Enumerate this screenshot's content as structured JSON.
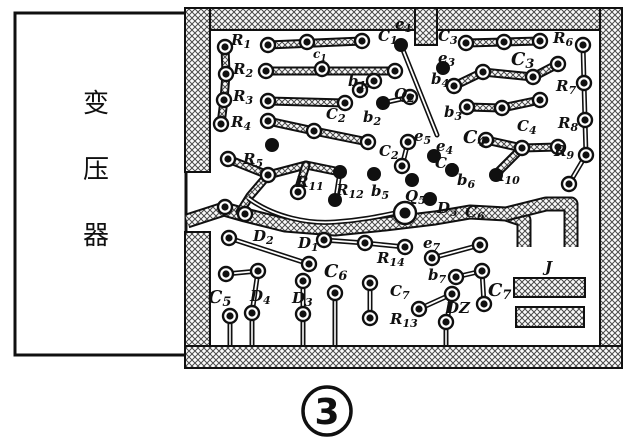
{
  "figure": {
    "caption_number": "3"
  },
  "transformer": {
    "label": "变压器",
    "chars": [
      "变",
      "压",
      "器"
    ]
  },
  "board": {
    "border_color": "#101010",
    "hatch_color": "#4a4a4a",
    "labels": [
      {
        "t": "R",
        "s": "1",
        "x": 231,
        "y": 45
      },
      {
        "t": "R",
        "s": "2",
        "x": 233,
        "y": 74
      },
      {
        "t": "R",
        "s": "3",
        "x": 233,
        "y": 101
      },
      {
        "t": "R",
        "s": "4",
        "x": 231,
        "y": 127
      },
      {
        "t": "R",
        "s": "5",
        "x": 243,
        "y": 164
      },
      {
        "t": "C",
        "s": "1",
        "x": 378,
        "y": 41
      },
      {
        "t": "c",
        "s": "1",
        "x": 313,
        "y": 58,
        "small": true
      },
      {
        "t": "e",
        "s": "1",
        "x": 395,
        "y": 29
      },
      {
        "t": "b",
        "s": "1",
        "x": 348,
        "y": 86
      },
      {
        "t": "C",
        "s": "2",
        "x": 326,
        "y": 119
      },
      {
        "t": "b",
        "s": "2",
        "x": 363,
        "y": 122
      },
      {
        "t": "C",
        "s": "2",
        "x": 379,
        "y": 156
      },
      {
        "t": "Q",
        "s": "2",
        "x": 394,
        "y": 99
      },
      {
        "t": "C",
        "s": "3",
        "x": 438,
        "y": 41
      },
      {
        "t": "e",
        "s": "3",
        "x": 438,
        "y": 63
      },
      {
        "t": "b",
        "s": "4",
        "x": 431,
        "y": 84
      },
      {
        "t": "C",
        "s": "3",
        "x": 511,
        "y": 65,
        "bold": true
      },
      {
        "t": "R",
        "s": "6",
        "x": 553,
        "y": 43
      },
      {
        "t": "R",
        "s": "7",
        "x": 556,
        "y": 91
      },
      {
        "t": "b",
        "s": "3",
        "x": 444,
        "y": 117
      },
      {
        "t": "C",
        "s": "4",
        "x": 463,
        "y": 143,
        "bold": true
      },
      {
        "t": "C",
        "s": "4",
        "x": 517,
        "y": 131
      },
      {
        "t": "R",
        "s": "8",
        "x": 558,
        "y": 128
      },
      {
        "t": "R",
        "s": "9",
        "x": 554,
        "y": 156
      },
      {
        "t": "e",
        "s": "5",
        "x": 414,
        "y": 141
      },
      {
        "t": "e",
        "s": "4",
        "x": 436,
        "y": 151
      },
      {
        "t": "C",
        "s": "6",
        "x": 435,
        "y": 168
      },
      {
        "t": "b",
        "s": "6",
        "x": 457,
        "y": 185
      },
      {
        "t": "R",
        "s": "10",
        "x": 492,
        "y": 181
      },
      {
        "t": "b",
        "s": "5",
        "x": 371,
        "y": 196
      },
      {
        "t": "Q",
        "s": "5",
        "x": 405,
        "y": 201
      },
      {
        "t": "D",
        "s": "5",
        "x": 437,
        "y": 213
      },
      {
        "t": "C",
        "s": "6",
        "x": 465,
        "y": 217
      },
      {
        "t": "R",
        "s": "11",
        "x": 296,
        "y": 187
      },
      {
        "t": "R",
        "s": "12",
        "x": 336,
        "y": 195
      },
      {
        "t": "D",
        "s": "2",
        "x": 253,
        "y": 241
      },
      {
        "t": "D",
        "s": "1",
        "x": 298,
        "y": 248
      },
      {
        "t": "R",
        "s": "14",
        "x": 377,
        "y": 263
      },
      {
        "t": "C",
        "s": "6",
        "x": 324,
        "y": 277,
        "bold": true
      },
      {
        "t": "e",
        "s": "7",
        "x": 423,
        "y": 248
      },
      {
        "t": "b",
        "s": "7",
        "x": 428,
        "y": 280
      },
      {
        "t": "C",
        "s": "7",
        "x": 390,
        "y": 296
      },
      {
        "t": "C",
        "s": "7",
        "x": 488,
        "y": 296,
        "bold": true
      },
      {
        "t": "DZ",
        "s": "",
        "x": 446,
        "y": 313
      },
      {
        "t": "R",
        "s": "13",
        "x": 390,
        "y": 324
      },
      {
        "t": "J",
        "s": "",
        "x": 545,
        "y": 272
      },
      {
        "t": "C",
        "s": "5",
        "x": 208,
        "y": 303,
        "bold": true
      },
      {
        "t": "D",
        "s": "4",
        "x": 250,
        "y": 301
      },
      {
        "t": "D",
        "s": "3",
        "x": 292,
        "y": 303
      }
    ],
    "pads_ring": [
      [
        225,
        47
      ],
      [
        226,
        74
      ],
      [
        224,
        100
      ],
      [
        221,
        124
      ],
      [
        228,
        159
      ],
      [
        268,
        45
      ],
      [
        307,
        42
      ],
      [
        362,
        41
      ],
      [
        266,
        71
      ],
      [
        322,
        69
      ],
      [
        395,
        71
      ],
      [
        268,
        101
      ],
      [
        345,
        103
      ],
      [
        360,
        90
      ],
      [
        374,
        81
      ],
      [
        268,
        121
      ],
      [
        314,
        131
      ],
      [
        368,
        142
      ],
      [
        410,
        97
      ],
      [
        466,
        43
      ],
      [
        504,
        42
      ],
      [
        540,
        41
      ],
      [
        583,
        45
      ],
      [
        454,
        86
      ],
      [
        483,
        72
      ],
      [
        533,
        77
      ],
      [
        558,
        64
      ],
      [
        584,
        83
      ],
      [
        467,
        107
      ],
      [
        502,
        108
      ],
      [
        540,
        100
      ],
      [
        585,
        120
      ],
      [
        486,
        140
      ],
      [
        522,
        148
      ],
      [
        558,
        147
      ],
      [
        586,
        155
      ],
      [
        569,
        184
      ],
      [
        268,
        175
      ],
      [
        298,
        192
      ],
      [
        408,
        142
      ],
      [
        402,
        166
      ],
      [
        225,
        207
      ],
      [
        245,
        214
      ],
      [
        229,
        238
      ],
      [
        309,
        264
      ],
      [
        324,
        240
      ],
      [
        365,
        243
      ],
      [
        405,
        247
      ],
      [
        226,
        274
      ],
      [
        258,
        271
      ],
      [
        303,
        281
      ],
      [
        370,
        283
      ],
      [
        370,
        318
      ],
      [
        432,
        258
      ],
      [
        480,
        245
      ],
      [
        456,
        277
      ],
      [
        482,
        271
      ],
      [
        484,
        304
      ],
      [
        452,
        294
      ],
      [
        419,
        309
      ]
    ],
    "pads_solid": [
      [
        401,
        45
      ],
      [
        443,
        68
      ],
      [
        383,
        103
      ],
      [
        272,
        145
      ],
      [
        340,
        172
      ],
      [
        374,
        174
      ],
      [
        335,
        200
      ],
      [
        434,
        156
      ],
      [
        452,
        170
      ],
      [
        412,
        180
      ],
      [
        430,
        199
      ],
      [
        496,
        175
      ]
    ],
    "pad_big": [
      405,
      213
    ],
    "pins_with_stem": [
      {
        "x": 230,
        "y": 316
      },
      {
        "x": 252,
        "y": 313
      },
      {
        "x": 303,
        "y": 314
      },
      {
        "x": 335,
        "y": 293
      },
      {
        "x": 446,
        "y": 322
      }
    ],
    "stem_bottom_y": 347,
    "traces_hatch": [
      [
        [
          225,
          47
        ],
        [
          226,
          74
        ],
        [
          224,
          100
        ],
        [
          221,
          124
        ]
      ],
      [
        [
          268,
          45
        ],
        [
          362,
          41
        ]
      ],
      [
        [
          266,
          71
        ],
        [
          393,
          71
        ]
      ],
      [
        [
          268,
          101
        ],
        [
          345,
          103
        ]
      ],
      [
        [
          268,
          121
        ],
        [
          314,
          131
        ],
        [
          368,
          142
        ]
      ],
      [
        [
          228,
          159
        ],
        [
          268,
          175
        ],
        [
          306,
          165
        ],
        [
          340,
          172
        ]
      ],
      [
        [
          306,
          165
        ],
        [
          298,
          191
        ]
      ],
      [
        [
          268,
          175
        ],
        [
          250,
          196
        ],
        [
          240,
          212
        ]
      ],
      [
        [
          466,
          43
        ],
        [
          540,
          41
        ]
      ],
      [
        [
          454,
          86
        ],
        [
          483,
          72
        ],
        [
          533,
          77
        ],
        [
          558,
          64
        ]
      ],
      [
        [
          467,
          107
        ],
        [
          502,
          108
        ],
        [
          540,
          100
        ]
      ],
      [
        [
          486,
          140
        ],
        [
          522,
          148
        ],
        [
          558,
          147
        ]
      ],
      [
        [
          522,
          148
        ],
        [
          498,
          172
        ]
      ]
    ],
    "traces_thin": [
      [
        [
          401,
          45
        ],
        [
          419,
          90
        ],
        [
          437,
          135
        ]
      ],
      [
        [
          583,
          45
        ],
        [
          584,
          83
        ],
        [
          585,
          120
        ],
        [
          586,
          155
        ],
        [
          570,
          182
        ]
      ],
      [
        [
          360,
          90
        ],
        [
          374,
          81
        ]
      ],
      [
        [
          229,
          238
        ],
        [
          309,
          264
        ]
      ],
      [
        [
          324,
          240
        ],
        [
          365,
          243
        ],
        [
          405,
          247
        ]
      ],
      [
        [
          226,
          274
        ],
        [
          258,
          271
        ]
      ],
      [
        [
          258,
          271
        ],
        [
          252,
          313
        ]
      ],
      [
        [
          303,
          281
        ],
        [
          303,
          314
        ]
      ],
      [
        [
          370,
          283
        ],
        [
          370,
          318
        ]
      ],
      [
        [
          432,
          258
        ],
        [
          480,
          245
        ]
      ],
      [
        [
          456,
          277
        ],
        [
          482,
          271
        ]
      ],
      [
        [
          452,
          294
        ],
        [
          419,
          309
        ]
      ],
      [
        [
          482,
          271
        ],
        [
          484,
          304
        ]
      ],
      [
        [
          340,
          172
        ],
        [
          336,
          198
        ]
      ],
      [
        [
          383,
          103
        ],
        [
          410,
          97
        ]
      ],
      [
        [
          408,
          142
        ],
        [
          402,
          166
        ]
      ],
      [
        [
          452,
          294
        ],
        [
          447,
          320
        ]
      ]
    ],
    "trace_curvy": "M248,198 C275,218 310,224 335,222 C365,220 385,215 400,212",
    "bands_wide": [
      "M187,221 L224,209 L245,215 L285,225 L335,229 L385,224 L435,218 L470,212 L506,214 L524,220 L524,247",
      "M506,214 L546,204 L571,204 L571,247"
    ],
    "border_rects": [
      [
        185,
        8,
        437,
        22
      ],
      [
        600,
        8,
        22,
        360
      ],
      [
        185,
        346,
        437,
        22
      ],
      [
        185,
        8,
        25,
        164
      ],
      [
        185,
        232,
        25,
        114
      ]
    ],
    "tab_rect": [
      415,
      8,
      22,
      37
    ],
    "jumper_rects": [
      [
        514,
        278,
        71,
        19
      ],
      [
        516,
        307,
        68,
        20
      ]
    ]
  }
}
